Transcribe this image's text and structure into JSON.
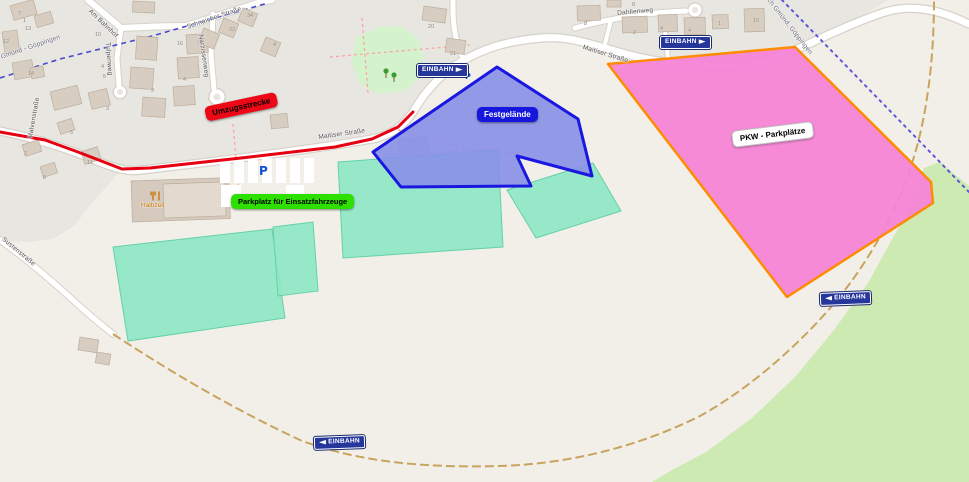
{
  "map": {
    "area_labels": {
      "umzugsstrecke": {
        "text": "Umzugsstrecke"
      },
      "einsatzfahrzeuge": {
        "text": "Parkplatz für Einsatzfahrzeuge"
      },
      "festgelaende": {
        "text": "Festgelände"
      },
      "pkw": {
        "text": "PKW - Parkplätze"
      }
    },
    "signs": [
      {
        "text": "EINBAHN",
        "dir": "right",
        "x": 417,
        "y": 64,
        "rot": 0
      },
      {
        "text": "EINBAHN",
        "dir": "right",
        "x": 660,
        "y": 36,
        "rot": 0
      },
      {
        "text": "EINBAHN",
        "dir": "left",
        "x": 820,
        "y": 292,
        "rot": -2
      },
      {
        "text": "EINBAHN",
        "dir": "left",
        "x": 314,
        "y": 436,
        "rot": -2
      }
    ],
    "streets": [
      {
        "name": "Am Bahnhof",
        "x": 92,
        "y": 8,
        "rot": 44
      },
      {
        "name": "Tulpenweg",
        "x": 111,
        "y": 42,
        "rot": 86
      },
      {
        "name": "Narzissenweg",
        "x": 204,
        "y": 34,
        "rot": 82
      },
      {
        "name": "Schnaicher Straße",
        "x": 186,
        "y": 24,
        "rot": -19
      },
      {
        "name": "Dahlienweg",
        "x": 617,
        "y": 10,
        "rot": -5
      },
      {
        "name": "Maitiser Straße",
        "x": 318,
        "y": 134,
        "rot": -8
      },
      {
        "name": "Maitiser Straße",
        "x": 584,
        "y": 44,
        "rot": 17
      },
      {
        "name": "Malvenstraße",
        "x": 27,
        "y": 138,
        "rot": -80
      },
      {
        "name": "Sustenstraße",
        "x": 5,
        "y": 236,
        "rot": 40
      }
    ],
    "rail_labels": [
      {
        "name": "Gmünd - Göppingen",
        "x": 0,
        "y": 54,
        "rot": -19
      },
      {
        "name": "Schwäbisch Gmünd, Göppingen",
        "x": 753,
        "y": -26,
        "rot": 52
      }
    ],
    "house_numbers": [
      {
        "n": "7",
        "x": 18,
        "y": 11
      },
      {
        "n": "1",
        "x": 23,
        "y": 18
      },
      {
        "n": "13",
        "x": 25,
        "y": 26
      },
      {
        "n": "12",
        "x": 3,
        "y": 39
      },
      {
        "n": "10",
        "x": 95,
        "y": 32
      },
      {
        "n": "14",
        "x": 28,
        "y": 71
      },
      {
        "n": "4",
        "x": 101,
        "y": 64
      },
      {
        "n": "5",
        "x": 103,
        "y": 74
      },
      {
        "n": "16",
        "x": 177,
        "y": 41
      },
      {
        "n": "22",
        "x": 229,
        "y": 27
      },
      {
        "n": "34",
        "x": 247,
        "y": 13
      },
      {
        "n": "4",
        "x": 273,
        "y": 42
      },
      {
        "n": "4",
        "x": 183,
        "y": 77
      },
      {
        "n": "3",
        "x": 151,
        "y": 88
      },
      {
        "n": "3",
        "x": 106,
        "y": 106
      },
      {
        "n": "5",
        "x": 70,
        "y": 130
      },
      {
        "n": "2",
        "x": 24,
        "y": 151
      },
      {
        "n": "11",
        "x": 87,
        "y": 160
      },
      {
        "n": "8",
        "x": 43,
        "y": 175
      },
      {
        "n": "20",
        "x": 428,
        "y": 24
      },
      {
        "n": "21",
        "x": 450,
        "y": 51
      },
      {
        "n": "8",
        "x": 584,
        "y": 21
      },
      {
        "n": "8",
        "x": 632,
        "y": 2
      },
      {
        "n": "2",
        "x": 633,
        "y": 30
      },
      {
        "n": "4",
        "x": 660,
        "y": 26
      },
      {
        "n": "4",
        "x": 688,
        "y": 28
      },
      {
        "n": "1",
        "x": 718,
        "y": 21
      },
      {
        "n": "10",
        "x": 753,
        "y": 18
      }
    ],
    "parking_icons": [
      {
        "t": "P",
        "x": 259,
        "y": 165,
        "size": 12
      },
      {
        "t": "P",
        "x": 465,
        "y": 73,
        "size": 8
      }
    ],
    "poi": {
      "restaurant": {
        "name": "Halbzeit"
      }
    },
    "colors": {
      "route_red": "#e60012",
      "festival_fill": "#8790e7",
      "festival_stroke": "#1a18e0",
      "pkw_fill": "#f584d6",
      "pkw_stroke": "#ff8c00",
      "staging_fill": "#8fe7c4",
      "staging_stroke": "#63d1a6",
      "label_red": "#ed0717",
      "label_green": "#2de000",
      "label_blue": "#1517dc",
      "label_white": "#ffffff",
      "sign_blue": "#26379c",
      "parking_p": "#0f4fd8"
    }
  }
}
